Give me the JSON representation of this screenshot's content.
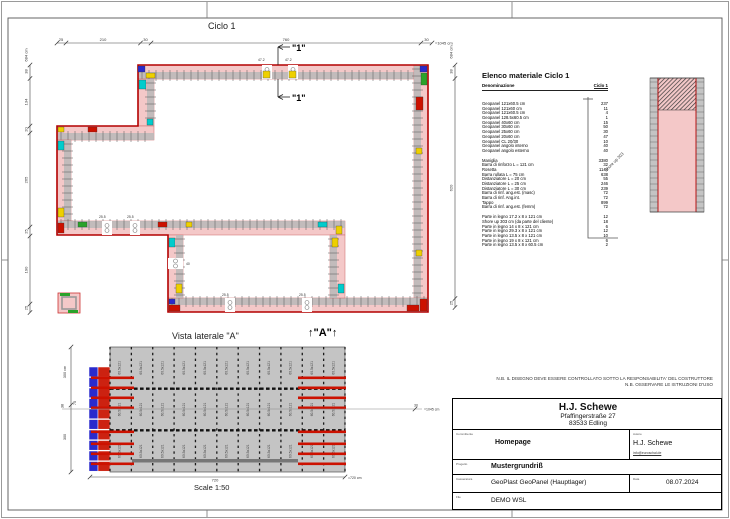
{
  "plan": {
    "title": "Ciclo 1",
    "section_marker": "\"1\"",
    "top_dims": [
      "25",
      "210",
      "30",
      "760",
      "30"
    ],
    "top_total": "=1045 cm",
    "left_dims": [
      "38",
      "134",
      "20",
      "265",
      "25",
      "190",
      "25"
    ],
    "left_total": "684 cm",
    "right_dims": [
      "38",
      "620",
      "25"
    ],
    "right_total": "684 cm",
    "gap_labels_top": [
      "47.2",
      "47.2"
    ],
    "gap_labels_mid": [
      "25.5",
      "25.5"
    ],
    "gap_labels_bottom": [
      "25.5",
      "25.5"
    ],
    "gap_label_side": "40"
  },
  "detail": {
    "annotation": "Shore up 303"
  },
  "side_view": {
    "title": "Vista laterale \"A\"",
    "direction_marker": "↑\"A\"↑",
    "scale_label": "Scale 1:50",
    "panel_label": "60.5x121",
    "dim_left_total": "300 cm",
    "dim_left_seg1": "300",
    "dim_left_seg2": "38",
    "dim_left_seg3": "75",
    "dim_bottom": "720",
    "dim_bottom_total": "=720 cm",
    "dim_ref_seg": "30",
    "dim_ref_total": "=1045 cm"
  },
  "material_list": {
    "title": "Elenco materiale  Ciclo 1",
    "col_name": "Denominazione",
    "col_qty": "Ciclo 1",
    "groups": [
      {
        "items": [
          [
            "Geopanel 121x60.5 cm",
            "237"
          ],
          [
            "Geopanel 121x60 cm",
            "11"
          ],
          [
            "Geopanel 121x60.5 cm",
            "4"
          ],
          [
            "Geopanel 128.5x60.5 cm",
            "1"
          ],
          [
            "Geopanel 40x60 cm",
            "15"
          ],
          [
            "Geopanel 30x60 cm",
            "50"
          ],
          [
            "Geopanel 25x60 cm",
            "30"
          ],
          [
            "Geopanel 20x60 cm",
            "47"
          ],
          [
            "Geopanel CL 20/30",
            "10"
          ],
          [
            "Geopanel angolo interno",
            "40"
          ],
          [
            "Geopanel angolo esterno",
            "40"
          ]
        ]
      },
      {
        "items": [
          [
            "Maniglia",
            "3380"
          ],
          [
            "Barra di rinforzo L = 121 cm",
            "32"
          ],
          [
            "Rosetta",
            "1144"
          ],
          [
            "Barra rullata L = 75 cm",
            "638"
          ],
          [
            "Distanziatore L = 20 cm",
            "55"
          ],
          [
            "Distanziatore L = 25 cm",
            "246"
          ],
          [
            "Distanziatore L = 30 cm",
            "239"
          ],
          [
            "Barra di rinf. ang.est. (masc)",
            "72"
          ],
          [
            "Barra di rinf. Ang.int.",
            "72"
          ],
          [
            "Tappo",
            "899"
          ],
          [
            "Barra di rinf. ang.est. (femm)",
            "72"
          ]
        ]
      },
      {
        "items": [
          [
            "Parte in legno 17.2 x 8 x 121 cm",
            "12"
          ],
          [
            "Shore up 303 cm (da parte del cliente)",
            "18"
          ],
          [
            "Parte in legno 14 x 8 x 121 cm",
            "6"
          ],
          [
            "Parte in legno 29.3 x 8 x 121 cm",
            "12"
          ],
          [
            "Parte in legno 13.5 x 8 x 121 cm",
            "10"
          ],
          [
            "Parte in legno 19 x 8 x 121 cm",
            "6"
          ],
          [
            "Parte in legno 13.5 x 8 x 60.5 cm",
            "2"
          ]
        ]
      }
    ]
  },
  "notes": [
    "N.B. IL DISEGNO DEVE ESSERE CONTROLLATO SOTTO LA RESPONSABILITA' DEL COSTRUTTORE",
    "N.B. OSSERVARE LE ISTRUZIONI D'USO"
  ],
  "title_block": {
    "company": "H.J. Schewe",
    "address1": "Pfaffingerstraße 27",
    "address2": "83533 Edling",
    "client_label": "Committente",
    "client": "Homepage",
    "author_label": "Autore",
    "author": "H.J. Schewe",
    "author_email": "info@euroschal.de",
    "project_label": "Progetto",
    "project": "Mustergrundriß",
    "formwork_label": "Casseratura",
    "formwork": "GeoPlast GeoPanel (Hauptlager)",
    "date_label": "Data",
    "date": "08.07.2024",
    "file_label": "File",
    "file": "DEMO WSL"
  },
  "colors": {
    "wall_fill": "#f4c8c8",
    "wall_outline": "#b30000",
    "panel_band": "#b8b8b8",
    "side_panel": "#c4c4c4",
    "bar_red": "#cc1100",
    "cell_blue": "#2a2acc"
  }
}
